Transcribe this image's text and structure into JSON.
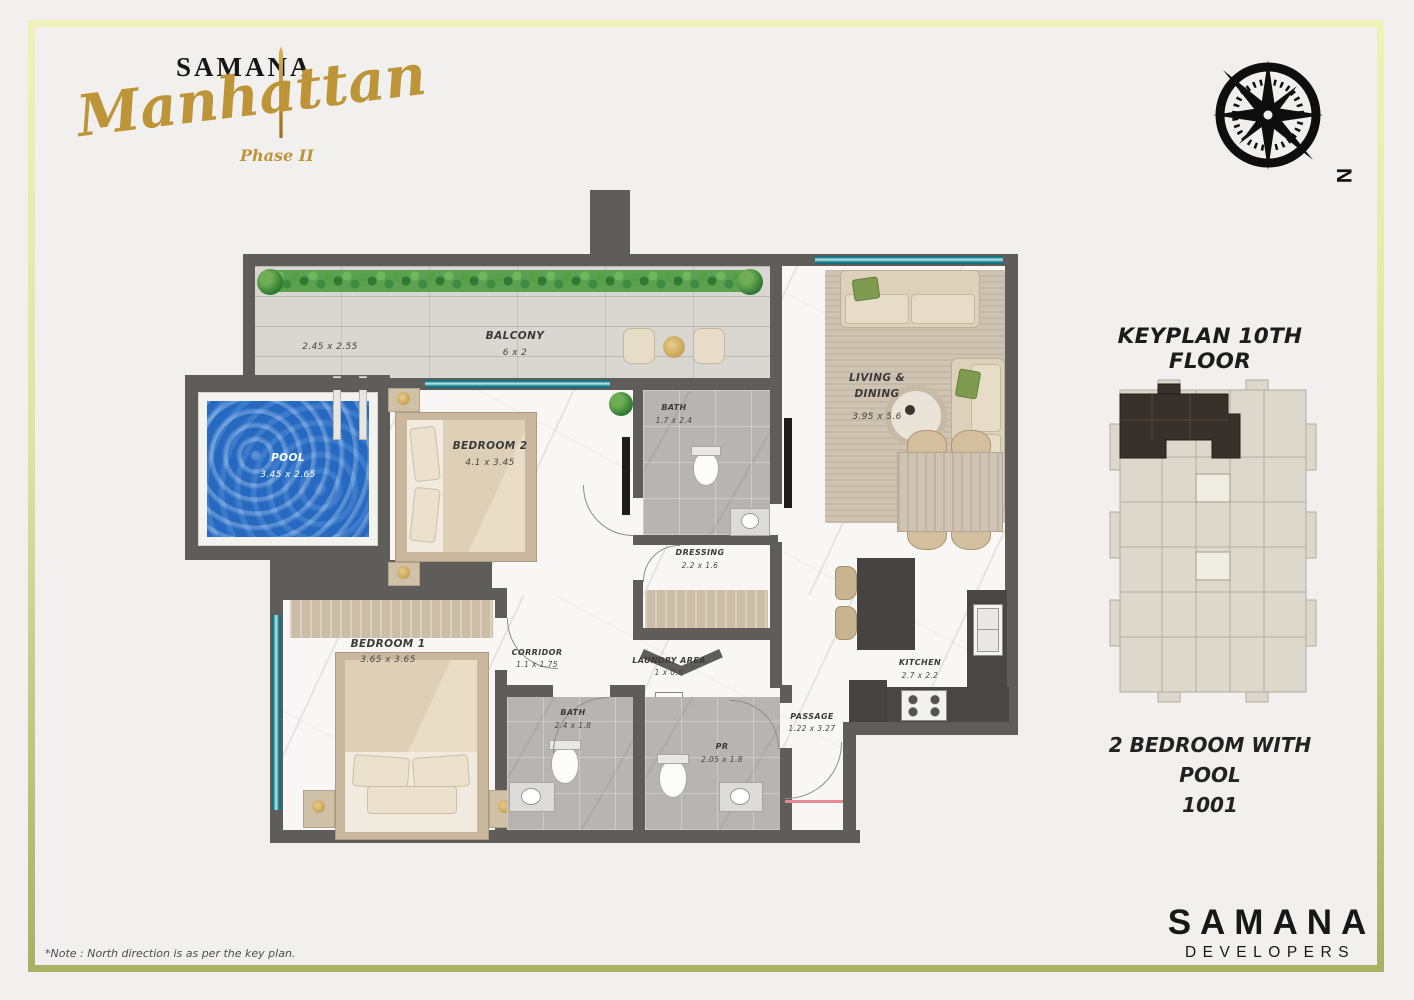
{
  "brand": {
    "name": "SAMANA",
    "project": "Manhattan",
    "phase": "Phase II"
  },
  "compass": {
    "north": "N"
  },
  "plan": {
    "balcony": {
      "label": "BALCONY",
      "dim": "6 x 2",
      "side_dim": "2.45 x 2.55"
    },
    "pool": {
      "label": "POOL",
      "dim": "3.45 x 2.65"
    },
    "bedroom2": {
      "label": "BEDROOM 2",
      "dim": "4.1 x 3.45"
    },
    "bath2": {
      "label": "BATH",
      "dim": "1.7 x 2.4"
    },
    "dressing": {
      "label": "DRESSING",
      "dim": "2.2 x 1.6"
    },
    "living": {
      "line1": "LIVING &",
      "line2": "DINING",
      "dim": "3.95 x 5.6"
    },
    "bedroom1": {
      "label": "BEDROOM 1",
      "dim": "3.65 x 3.65"
    },
    "corridor": {
      "label": "CORRIDOR",
      "dim": "1.1 x 1.75"
    },
    "laundry": {
      "label": "LAUNDRY AREA",
      "dim": "1 x 0.8"
    },
    "bath1": {
      "label": "BATH",
      "dim": "2.4 x 1.8"
    },
    "pr": {
      "label": "PR",
      "dim": "2.05 x 1.8"
    },
    "passage": {
      "label": "PASSAGE",
      "dim": "1.22 x 3.27"
    },
    "kitchen": {
      "label": "KITCHEN",
      "dim": "2.7 x 2.2"
    }
  },
  "keyplan": {
    "title": "KEYPLAN 10TH FLOOR",
    "unit_type": "2 BEDROOM WITH POOL",
    "unit_number": "1001"
  },
  "developer": {
    "name": "SAMANA",
    "subtitle": "DEVELOPERS"
  },
  "note": {
    "text": "*Note : North direction is as per the key plan."
  },
  "colors": {
    "gold": "#bd9538",
    "frame_top": "#f1f2bb",
    "frame_bottom": "#a7b166",
    "pool_blue": "#2a6fc4",
    "glass_teal": "#0e7484",
    "wall_gray": "#5f5d5a"
  }
}
